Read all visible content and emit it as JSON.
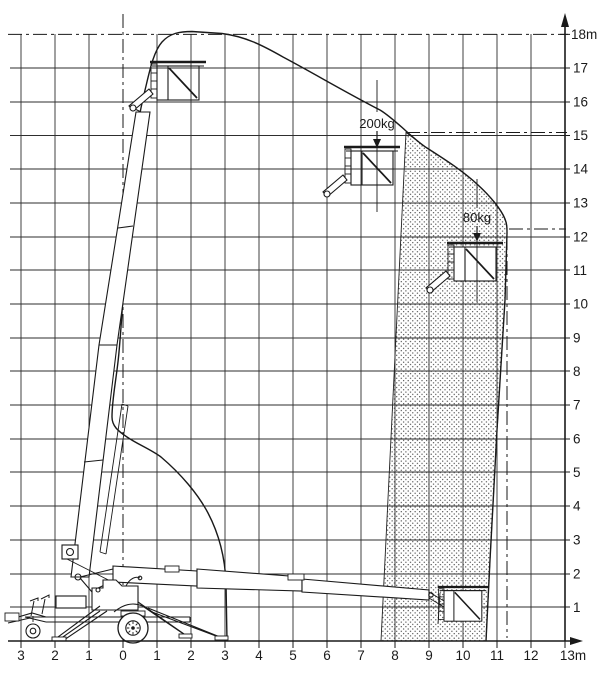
{
  "figure": {
    "kind": "working-envelope-diagram",
    "subject": "trailer-mounted telescopic boom lift, side view",
    "units": "m"
  },
  "x_axis": {
    "labels": [
      "3",
      "2",
      "1",
      "0",
      "1",
      "2",
      "3",
      "4",
      "5",
      "6",
      "7",
      "8",
      "9",
      "10",
      "11",
      "12",
      "13m"
    ],
    "arrow": "right"
  },
  "y_axis": {
    "labels": [
      "18m",
      "17",
      "16",
      "15",
      "14",
      "13",
      "12",
      "11",
      "10",
      "9",
      "8",
      "7",
      "6",
      "5",
      "4",
      "3",
      "2",
      "1"
    ],
    "arrow": "up"
  },
  "annotations": {
    "load_200": "200kg",
    "load_80": "80kg"
  },
  "colors": {
    "paper": "#ffffff",
    "line": "#1a1a1a",
    "grid": "#2e2e2e",
    "stipple_dot": "#3d3d3d"
  },
  "chart_data": {
    "type": "diagram",
    "title": "",
    "x_axis": {
      "unit": "m",
      "range": [
        -3,
        13
      ],
      "tick_step": 1
    },
    "y_axis": {
      "unit": "m",
      "range": [
        0,
        18
      ],
      "tick_step": 1
    },
    "grid": true,
    "envelope_outline_m": [
      [
        3.1,
        0
      ],
      [
        3.05,
        2.1
      ],
      [
        2.9,
        3.0
      ],
      [
        2.6,
        3.7
      ],
      [
        2.2,
        4.4
      ],
      [
        1.7,
        5.0
      ],
      [
        1.1,
        5.5
      ],
      [
        0.6,
        5.8
      ],
      [
        0.3,
        6.0
      ],
      [
        -0.3,
        6.6
      ],
      [
        -0.2,
        8.4
      ],
      [
        0.0,
        10.1
      ],
      [
        0.2,
        12.2
      ],
      [
        0.3,
        13.3
      ],
      [
        0.4,
        14.8
      ],
      [
        0.6,
        16.0
      ],
      [
        0.7,
        16.6
      ],
      [
        0.9,
        17.2
      ],
      [
        1.05,
        17.7
      ],
      [
        1.3,
        17.9
      ],
      [
        1.6,
        18.1
      ],
      [
        2.9,
        18.1
      ],
      [
        3.5,
        17.8
      ],
      [
        4.3,
        17.5
      ],
      [
        5.5,
        17.0
      ],
      [
        6.7,
        16.5
      ],
      [
        7.7,
        15.8
      ],
      [
        8.4,
        15.1
      ],
      [
        9.1,
        14.6
      ],
      [
        10.2,
        13.6
      ],
      [
        11.1,
        12.8
      ],
      [
        11.5,
        12.2
      ],
      [
        11.45,
        10.7
      ],
      [
        11.3,
        7.8
      ],
      [
        11.15,
        4.8
      ],
      [
        11.0,
        2.4
      ],
      [
        10.85,
        0
      ]
    ],
    "restricted_zone_80kg_m": {
      "fill": "stipple-dots",
      "left_edge": [
        [
          8.4,
          15.1
        ],
        [
          7.7,
          0.0
        ]
      ],
      "right_edge_follows_envelope": true,
      "bottom": 0
    },
    "reference_lines_dashdot_m": {
      "top_height": 18.0,
      "height_at_200kg_limit": 15.1,
      "height_at_80kg_limit": 12.2,
      "max_outreach_x": 11.5,
      "slew_axis_x": 0.0
    },
    "load_limit_markers": [
      {
        "label": "200kg",
        "basket_position_m": [
          7.4,
          14.2
        ]
      },
      {
        "label": "80kg",
        "basket_position_m": [
          10.5,
          11.3
        ]
      }
    ],
    "machine_positions": [
      "boom fully raised (basket ~16.5m)",
      "boom horizontal (basket ~1m at ~10m outreach)"
    ]
  }
}
